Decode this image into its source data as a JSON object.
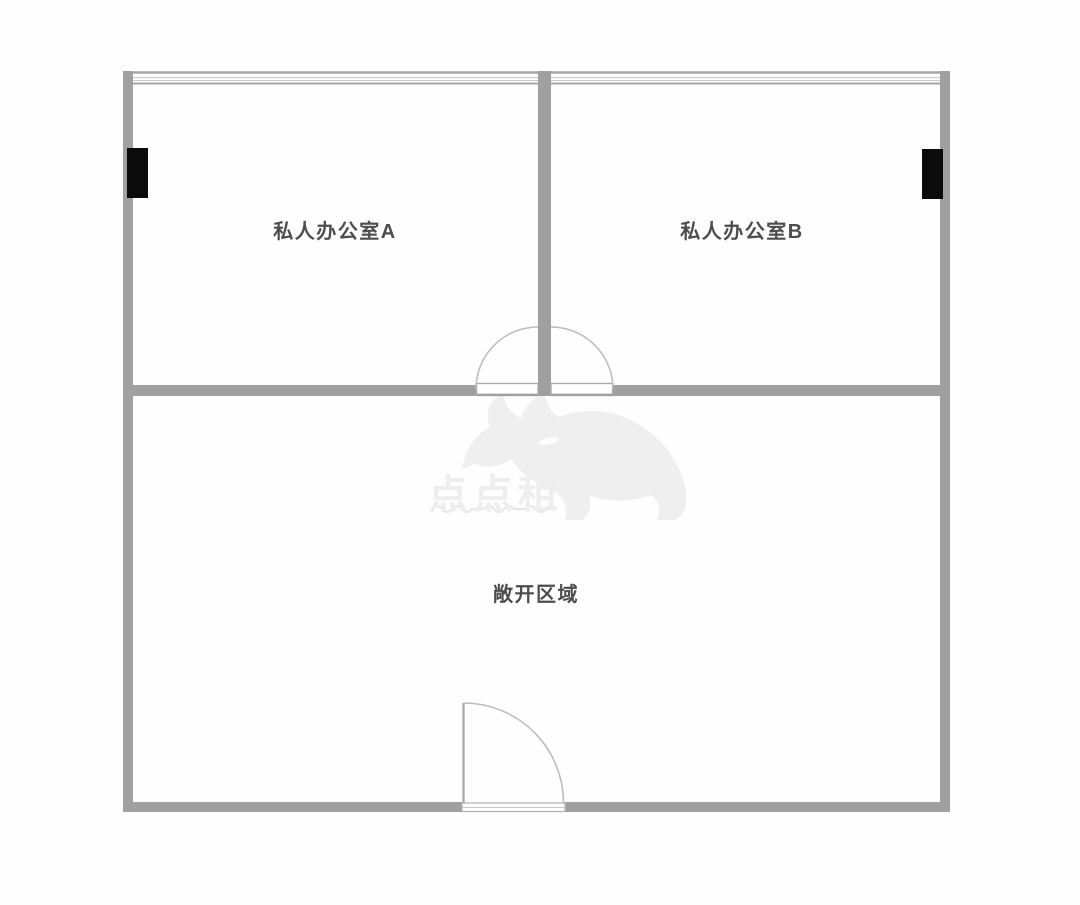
{
  "page": {
    "type": "floor-plan"
  },
  "rooms": {
    "office_a": {
      "label": "私人办公室A"
    },
    "office_b": {
      "label": "私人办公室B"
    },
    "open_area": {
      "label": "敞开区域"
    }
  },
  "watermark": {
    "brand": "点点租",
    "logo": "rhino-logo"
  },
  "colors": {
    "wall": "#a0a0a0",
    "window_line": "#a6a6a6",
    "window_line_thin": "#c8c8c8",
    "door_arc": "#bbbbbb",
    "column": "#0b0b0b",
    "label_text": "#4d4d4d",
    "watermark": "#eeeeee",
    "background": "#ffffff"
  }
}
